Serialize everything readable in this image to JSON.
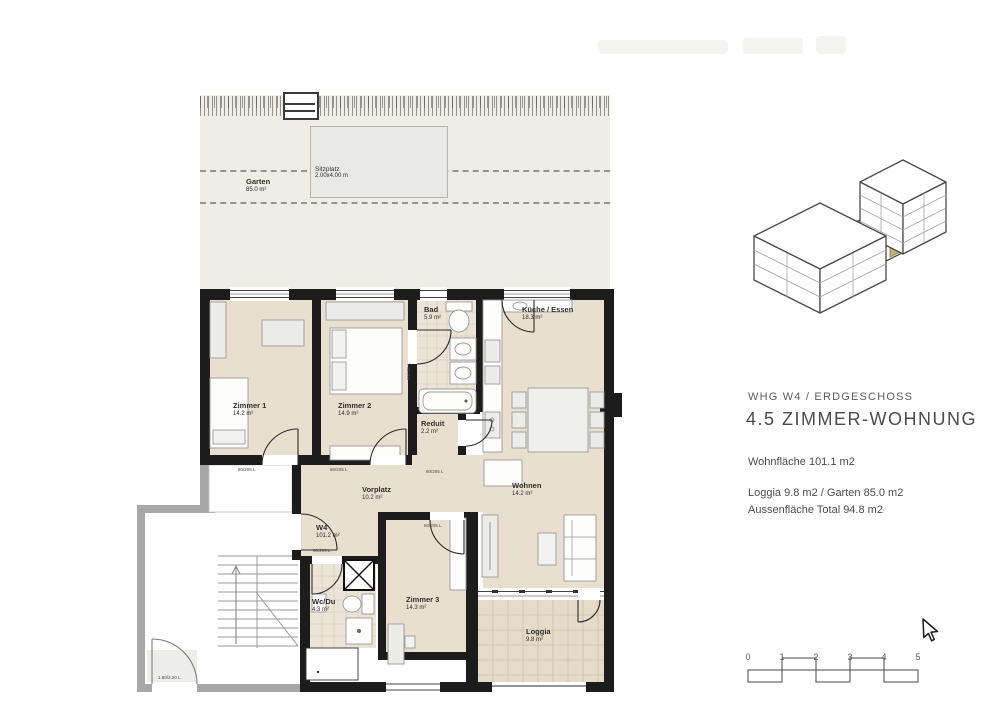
{
  "garden": {
    "label": "Garten",
    "area": "85.0 m²",
    "sitzplatz_label": "Sitzplatz",
    "sitzplatz_dim": "2.00x4.00 m"
  },
  "rooms": {
    "zimmer1": {
      "name": "Zimmer 1",
      "area": "14.2 m²"
    },
    "zimmer2": {
      "name": "Zimmer 2",
      "area": "14.9 m²"
    },
    "bad": {
      "name": "Bad",
      "area": "5.9 m²"
    },
    "kueche": {
      "name": "Küche / Essen",
      "area": "18.3 m²"
    },
    "reduit": {
      "name": "Reduit",
      "area": "2.2 m²"
    },
    "vorplatz": {
      "name": "Vorplatz",
      "area": "10.2 m²"
    },
    "w4": {
      "name": "W4",
      "area": "101.2 m²"
    },
    "wohnen": {
      "name": "Wohnen",
      "area": "14.2 m²"
    },
    "wcdu": {
      "name": "Wc/Du",
      "area": "4.3 m²"
    },
    "zimmer3": {
      "name": "Zimmer 3",
      "area": "14.3 m²"
    },
    "loggia": {
      "name": "Loggia",
      "area": "9.8 m²"
    }
  },
  "door_labels": [
    "80/205 L",
    "80/205 L",
    "80/205 L",
    "80/205 L",
    "80/205 L",
    "60/205 L",
    "1.80/2.20 L"
  ],
  "info_panel": {
    "subtitle": "WHG W4 / ERDGESCHOSS",
    "title": "4.5 ZIMMER-WOHNUNG",
    "wohnflaeche": "Wohnfläche 101.1 m2",
    "aussen_line1": "Loggia 9.8 m2 / Garten 85.0 m2",
    "aussen_line2": "Aussenfläche Total 94.8 m2"
  },
  "scale_bar": {
    "ticks": [
      "0",
      "1",
      "2",
      "3",
      "4",
      "5"
    ]
  },
  "colors": {
    "wall": "#1c1c1c",
    "stair_wall": "#a7a7a7",
    "floor": "#e9dfcf",
    "tile": "#ece4d7",
    "garden": "#f0ede4",
    "loggia_floor": "#e6dbc8",
    "unit_highlight": "#c9b078"
  }
}
